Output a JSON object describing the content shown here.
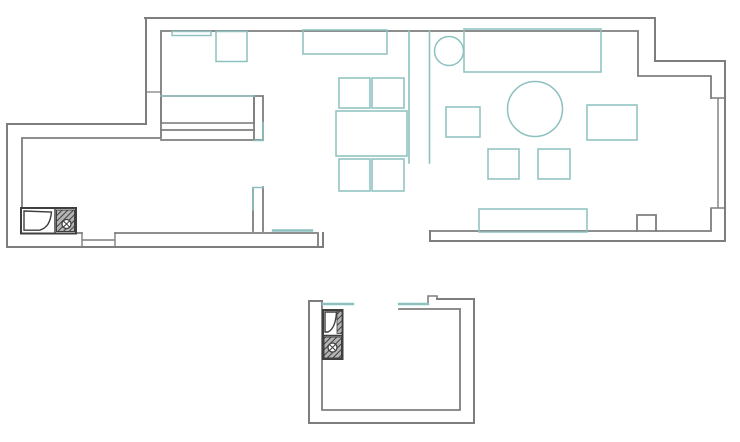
{
  "meta": {
    "document_type": "floor-plan-drawing",
    "canvas_width": 740,
    "canvas_height": 442
  },
  "colors": {
    "background": "#ffffff",
    "wall": "#7e7e7e",
    "furniture": "#8cc1bf",
    "fixture": "#3f3f3f",
    "hatch_bg": "#b4b4b4",
    "hatch_line": "#3f3f3f"
  },
  "plan": {
    "shapes": [
      {
        "name": "main-outer-wall",
        "type": "path",
        "d": "M145,18 H655 V61 H725 V241 H430 V231",
        "stroke": "wall",
        "sw": 2,
        "fill": "none"
      },
      {
        "name": "main-inner-wall",
        "type": "path",
        "d": "M711,98 V76 H638 V31 H161 V138 H22 V233 H82",
        "stroke": "wall",
        "sw": 1.8,
        "fill": "none"
      },
      {
        "name": "kitchen-wing-outer-wall",
        "type": "path",
        "d": "M146,18 V124 H7 V247 H323 V233",
        "stroke": "wall",
        "sw": 2,
        "fill": "none"
      },
      {
        "name": "kitchen-wing-inner-bottom-wall",
        "type": "path",
        "d": "M115,233 H318 V246",
        "stroke": "wall",
        "sw": 1.8,
        "fill": "none"
      },
      {
        "name": "living-inner-bottom-wall",
        "type": "path",
        "d": "M430,231 H711 V209",
        "stroke": "wall",
        "sw": 1.8,
        "fill": "none"
      },
      {
        "name": "right-window",
        "type": "path",
        "d": "M711,98 H725 M711,208 H725 M718,98 V208",
        "stroke": "wall",
        "sw": 1.4,
        "fill": "none"
      },
      {
        "name": "bedroom-south-wall-upper-line",
        "type": "path",
        "d": "M161,130 H254",
        "stroke": "wall",
        "sw": 1.8,
        "fill": "none"
      },
      {
        "name": "bedroom-south-wall-lower-line",
        "type": "path",
        "d": "M161,140 H263",
        "stroke": "wall",
        "sw": 1.8,
        "fill": "none"
      },
      {
        "name": "door-stub-upper",
        "type": "path",
        "d": "M254,140 V96 H263 V140",
        "stroke": "wall",
        "sw": 1.8,
        "fill": "none"
      },
      {
        "name": "door-stub-lower",
        "type": "path",
        "d": "M253,188 V231 M263,187 V231",
        "stroke": "wall",
        "sw": 1.8,
        "fill": "none"
      },
      {
        "name": "wall-pillar",
        "type": "path",
        "d": "M637,231 V215 H656 V231",
        "stroke": "wall",
        "sw": 1.8,
        "fill": "none"
      },
      {
        "name": "kitchen-window",
        "type": "path",
        "d": "M82,233 V247 M115,233 V247 M82,240 H115",
        "stroke": "wall",
        "sw": 1.4,
        "fill": "none"
      },
      {
        "name": "wall-joint-tick",
        "type": "path",
        "d": "M146,92 H161",
        "stroke": "wall",
        "sw": 1.2,
        "fill": "none"
      },
      {
        "name": "bathroom-outer-wall",
        "type": "path",
        "d": "M322,301 H309 V423 H474 V299 H437",
        "stroke": "wall",
        "sw": 2,
        "fill": "none"
      },
      {
        "name": "bathroom-wall-bump",
        "type": "path",
        "d": "M437,299 V296 H428 V303",
        "stroke": "wall",
        "sw": 1.6,
        "fill": "none"
      },
      {
        "name": "bathroom-inner-wall",
        "type": "path",
        "d": "M322,301 V410 H460 V309 H399",
        "stroke": "wall",
        "sw": 1.8,
        "fill": "none"
      },
      {
        "name": "partition-screen",
        "type": "path",
        "d": "M409,31 V163 M429.5,31 V163",
        "stroke": "furniture",
        "sw": 1.6,
        "fill": "none"
      },
      {
        "name": "hall-door-threshold",
        "type": "path",
        "d": "M273,230.5 H312",
        "stroke": "furniture",
        "sw": 2.4,
        "fill": "none"
      },
      {
        "name": "bathroom-sill-left",
        "type": "path",
        "d": "M323,304 H353",
        "stroke": "furniture",
        "sw": 2.4,
        "fill": "none"
      },
      {
        "name": "bathroom-sill-right",
        "type": "path",
        "d": "M399,304 H428",
        "stroke": "furniture",
        "sw": 2.4,
        "fill": "none"
      },
      {
        "name": "stub-upper-accent",
        "type": "path",
        "d": "M263,122.5 V140.5 H254",
        "stroke": "furniture",
        "sw": 1.5,
        "fill": "none"
      },
      {
        "name": "stub-lower-accent",
        "type": "path",
        "d": "M253,210 V187.5 H263",
        "stroke": "furniture",
        "sw": 1.5,
        "fill": "none"
      },
      {
        "name": "bedroom-shelf",
        "type": "rect",
        "x": 172,
        "y": 31.5,
        "w": 39,
        "h": 4,
        "stroke": "furniture",
        "sw": 1.4,
        "fill": "none"
      },
      {
        "name": "bedroom-cabinet",
        "type": "rect",
        "x": 216,
        "y": 31.5,
        "w": 31,
        "h": 30,
        "stroke": "furniture",
        "sw": 1.5,
        "fill": "none"
      },
      {
        "name": "wardrobe",
        "type": "rect",
        "x": 303,
        "y": 30,
        "w": 84,
        "h": 24,
        "stroke": "furniture",
        "sw": 1.5,
        "fill": "none"
      },
      {
        "name": "bed",
        "type": "rect",
        "x": 161,
        "y": 96,
        "w": 93,
        "h": 27,
        "stroke": "wall",
        "sw": 1.6,
        "fill": "none"
      },
      {
        "name": "bed-headboard-accent",
        "type": "path",
        "d": "M161,96 H254",
        "stroke": "furniture",
        "sw": 1.6,
        "fill": "none"
      },
      {
        "name": "sofa",
        "type": "rect",
        "x": 464,
        "y": 29,
        "w": 137,
        "h": 43,
        "stroke": "furniture",
        "sw": 1.5,
        "fill": "none"
      },
      {
        "name": "armchair-round",
        "type": "circle",
        "cx": 449,
        "cy": 51,
        "r": 14.5,
        "stroke": "furniture",
        "sw": 1.5,
        "fill": "none"
      },
      {
        "name": "round-table",
        "type": "circle",
        "cx": 535,
        "cy": 109,
        "r": 27.5,
        "stroke": "furniture",
        "sw": 1.5,
        "fill": "none"
      },
      {
        "name": "side-table",
        "type": "rect",
        "x": 446,
        "y": 107,
        "w": 34,
        "h": 30,
        "stroke": "furniture",
        "sw": 1.5,
        "fill": "none"
      },
      {
        "name": "ottoman",
        "type": "rect",
        "x": 587,
        "y": 105,
        "w": 50,
        "h": 35,
        "stroke": "furniture",
        "sw": 1.5,
        "fill": "none"
      },
      {
        "name": "floor-cushion-left",
        "type": "rect",
        "x": 488,
        "y": 149,
        "w": 31,
        "h": 30,
        "stroke": "furniture",
        "sw": 1.5,
        "fill": "none"
      },
      {
        "name": "floor-cushion-right",
        "type": "rect",
        "x": 538,
        "y": 149,
        "w": 32,
        "h": 30,
        "stroke": "furniture",
        "sw": 1.5,
        "fill": "none"
      },
      {
        "name": "tv-stand",
        "type": "rect",
        "x": 479,
        "y": 209,
        "w": 108,
        "h": 23,
        "stroke": "furniture",
        "sw": 1.5,
        "fill": "none"
      },
      {
        "name": "dining-chair-top-left",
        "type": "rect",
        "x": 339,
        "y": 78,
        "w": 31,
        "h": 30,
        "stroke": "furniture",
        "sw": 1.5,
        "fill": "none"
      },
      {
        "name": "dining-chair-top-right",
        "type": "rect",
        "x": 372,
        "y": 78,
        "w": 32,
        "h": 30,
        "stroke": "furniture",
        "sw": 1.5,
        "fill": "none"
      },
      {
        "name": "dining-chair-bottom-left",
        "type": "rect",
        "x": 339,
        "y": 159,
        "w": 31,
        "h": 32,
        "stroke": "furniture",
        "sw": 1.5,
        "fill": "none"
      },
      {
        "name": "dining-chair-bottom-right",
        "type": "rect",
        "x": 372,
        "y": 159,
        "w": 32,
        "h": 32,
        "stroke": "furniture",
        "sw": 1.5,
        "fill": "none"
      },
      {
        "name": "dining-table",
        "type": "rect",
        "x": 336,
        "y": 111,
        "w": 71,
        "h": 45,
        "stroke": "furniture",
        "sw": 1.5,
        "fill": "none"
      },
      {
        "name": "kitchen-unit-outline",
        "type": "rect",
        "x": 21,
        "y": 208,
        "w": 55,
        "h": 25.5,
        "stroke": "fixture",
        "sw": 2,
        "fill": "white"
      },
      {
        "name": "kitchen-unit-divider",
        "type": "path",
        "d": "M55,208 V233.5",
        "stroke": "fixture",
        "sw": 1.5,
        "fill": "none"
      },
      {
        "name": "kitchen-sink-basin",
        "type": "path",
        "d": "M24,211 L51.5,212 C50.5,221.5 47.5,228 39.5,230.2 L24,230.2 Z",
        "stroke": "fixture",
        "sw": 1.4,
        "fill": "white"
      },
      {
        "name": "kitchen-hob-hatch",
        "type": "rect",
        "x": 56.5,
        "y": 210,
        "w": 18,
        "h": 21.5,
        "stroke": "fixture",
        "sw": 1,
        "fill": "hatch"
      },
      {
        "name": "kitchen-hob-knob",
        "type": "circle",
        "cx": 66.5,
        "cy": 224,
        "r": 4.5,
        "stroke": "fixture",
        "sw": 1.3,
        "fill": "white"
      },
      {
        "name": "kitchen-knob-cross",
        "type": "path",
        "d": "M63.5,221 L69.5,227 M69.5,221 L63.5,227",
        "stroke": "fixture",
        "sw": 1,
        "fill": "none"
      },
      {
        "name": "bath-unit-outline",
        "type": "rect",
        "x": 323,
        "y": 310,
        "w": 19.5,
        "h": 49,
        "stroke": "fixture",
        "sw": 2,
        "fill": "white"
      },
      {
        "name": "bath-strip-hatch",
        "type": "rect",
        "x": 337,
        "y": 311.5,
        "w": 5,
        "h": 22,
        "stroke": "fixture",
        "sw": 0.8,
        "fill": "hatch"
      },
      {
        "name": "bath-sink-basin",
        "type": "path",
        "d": "M325,312 L336.5,312 C336,321 334,329 328,332 L325,332 Z",
        "stroke": "fixture",
        "sw": 1.4,
        "fill": "white"
      },
      {
        "name": "bath-unit-divider",
        "type": "path",
        "d": "M323,335.5 H342.5",
        "stroke": "fixture",
        "sw": 1.5,
        "fill": "none"
      },
      {
        "name": "bath-washer-hatch",
        "type": "rect",
        "x": 324,
        "y": 337,
        "w": 17.5,
        "h": 21,
        "stroke": "fixture",
        "sw": 1,
        "fill": "hatch"
      },
      {
        "name": "bath-washer-knob",
        "type": "circle",
        "cx": 332.5,
        "cy": 347.5,
        "r": 4.5,
        "stroke": "fixture",
        "sw": 1.3,
        "fill": "white"
      },
      {
        "name": "bath-knob-cross",
        "type": "path",
        "d": "M329.5,344.5 L335.5,350.5 M335.5,344.5 L329.5,350.5",
        "stroke": "fixture",
        "sw": 1,
        "fill": "none"
      }
    ]
  }
}
